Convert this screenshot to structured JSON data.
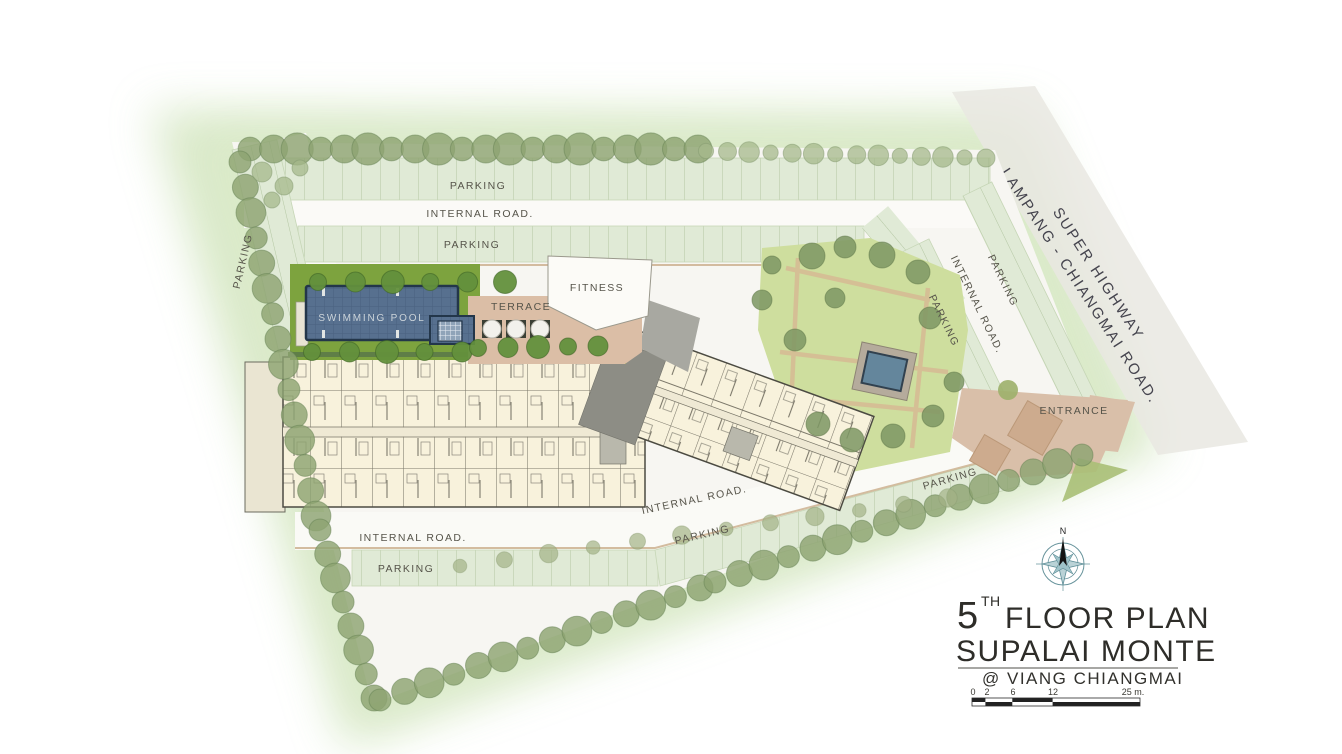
{
  "document_title": "5th Floor Plan - Supalai Monte @ Viang Chiangmai",
  "plan_labels": {
    "parking": "PARKING",
    "internal_road": "INTERNAL ROAD.",
    "swimming_pool": "SWIMMING POOL",
    "terrace": "TERRACE",
    "fitness": "FITNESS",
    "entrance": "ENTRANCE",
    "highway_line1": "SUPER HIGHWAY",
    "highway_line2": "LAMPANG - CHIANGMAI ROAD."
  },
  "title_block": {
    "floor_number": "5",
    "floor_ordinal_suffix": "TH",
    "floor_text": "FLOOR PLAN",
    "project_name": "SUPALAI MONTE",
    "location_line": "@ VIANG CHIANGMAI",
    "compass_north_label": "N",
    "scale_bar": {
      "ticks": [
        "0",
        "2",
        "6",
        "12"
      ],
      "end_label": "25 m."
    }
  },
  "colors": {
    "pool_water": "#57708f",
    "deck_green": "#7da33e",
    "parking_strip": "#e0ead6",
    "building_fill": "#f8f2dc",
    "terrace_tan": "#dbbea6",
    "entrance_tan": "#d9bfa9",
    "tree_green": "#8da471",
    "compass_teal": "#68949c",
    "title_text": "#2e2d29"
  }
}
